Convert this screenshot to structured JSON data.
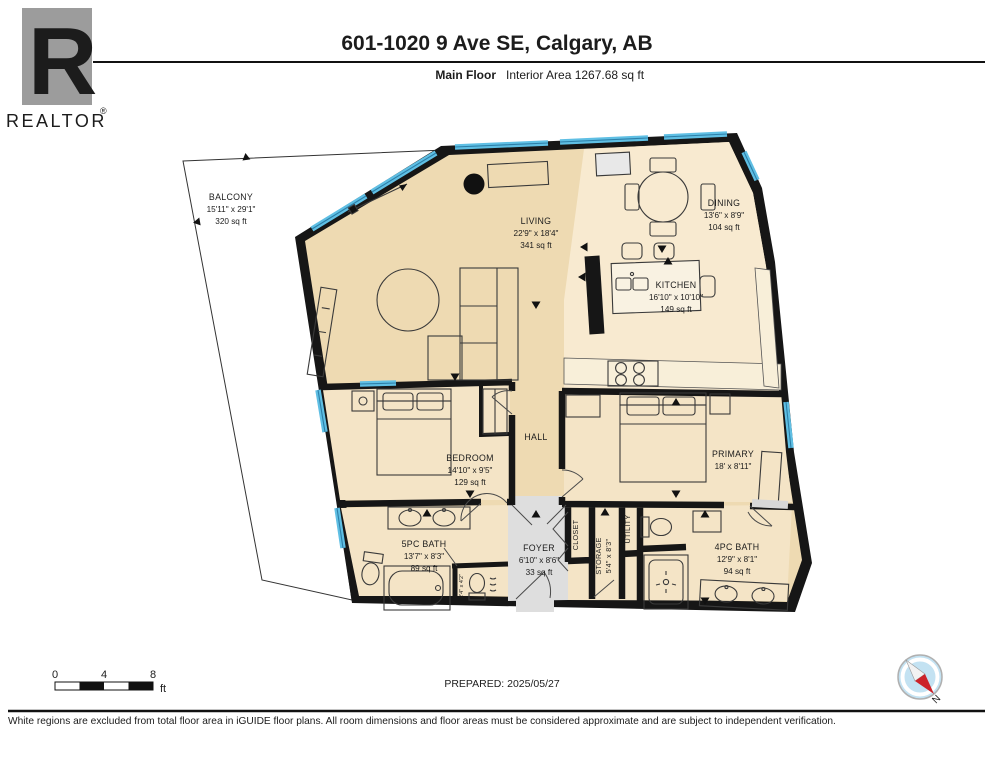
{
  "header": {
    "title": "601-1020 9 Ave SE, Calgary, AB",
    "floor_label": "Main Floor",
    "area_label": "Interior Area 1267.68 sq ft",
    "logo": {
      "letter": "R",
      "word": "REALTOR",
      "reg": "®"
    }
  },
  "plan": {
    "rooms": [
      {
        "key": "balcony",
        "name": "BALCONY",
        "dims": "15'11\" x 29'1\"",
        "area": "320 sq ft"
      },
      {
        "key": "living",
        "name": "LIVING",
        "dims": "22'9\" x 18'4\"",
        "area": "341 sq ft"
      },
      {
        "key": "dining",
        "name": "DINING",
        "dims": "13'6\" x 8'9\"",
        "area": "104 sq ft"
      },
      {
        "key": "kitchen",
        "name": "KITCHEN",
        "dims": "16'10\" x 10'10\"",
        "area": "149 sq ft"
      },
      {
        "key": "bedroom",
        "name": "BEDROOM",
        "dims": "14'10\" x 9'5\"",
        "area": "129 sq ft"
      },
      {
        "key": "hall",
        "name": "HALL"
      },
      {
        "key": "primary",
        "name": "PRIMARY",
        "dims": "18' x 8'11\""
      },
      {
        "key": "bath5",
        "name": "5PC BATH",
        "dims": "13'7\" x 8'3\"",
        "area": "89 sq ft"
      },
      {
        "key": "foyer",
        "name": "FOYER",
        "dims": "6'10\" x 8'6\"",
        "area": "33 sq ft"
      },
      {
        "key": "closet",
        "name": "CLOSET"
      },
      {
        "key": "storage",
        "name": "STORAGE",
        "dims": "5'4\" x 8'3\""
      },
      {
        "key": "utility",
        "name": "UTILITY"
      },
      {
        "key": "bath4",
        "name": "4PC BATH",
        "dims": "12'9\" x 8'1\"",
        "area": "94 sq ft"
      },
      {
        "key": "wc",
        "name": "",
        "dims": "2'4\" x 4'2\""
      }
    ]
  },
  "footer": {
    "scale": {
      "ticks": [
        "0",
        "4",
        "8"
      ],
      "unit": "ft"
    },
    "prepared": "PREPARED: 2025/05/27",
    "compass": "N",
    "disclaimer": "White regions are excluded from total floor area in iGUIDE floor plans. All room dimensions and floor areas must be considered approximate and are subject to independent verification."
  },
  "colors": {
    "wall": "#161616",
    "window_blue": "#5fbfe4",
    "floor_living": "#eedab2",
    "floor_rooms": "#f4e4c6",
    "floor_kitchen": "#f8ead0",
    "threshold_gray": "#dedede",
    "logo_gray": "#9c9c9c",
    "compass_red": "#cc2229",
    "compass_blue": "#c3e2f2"
  }
}
